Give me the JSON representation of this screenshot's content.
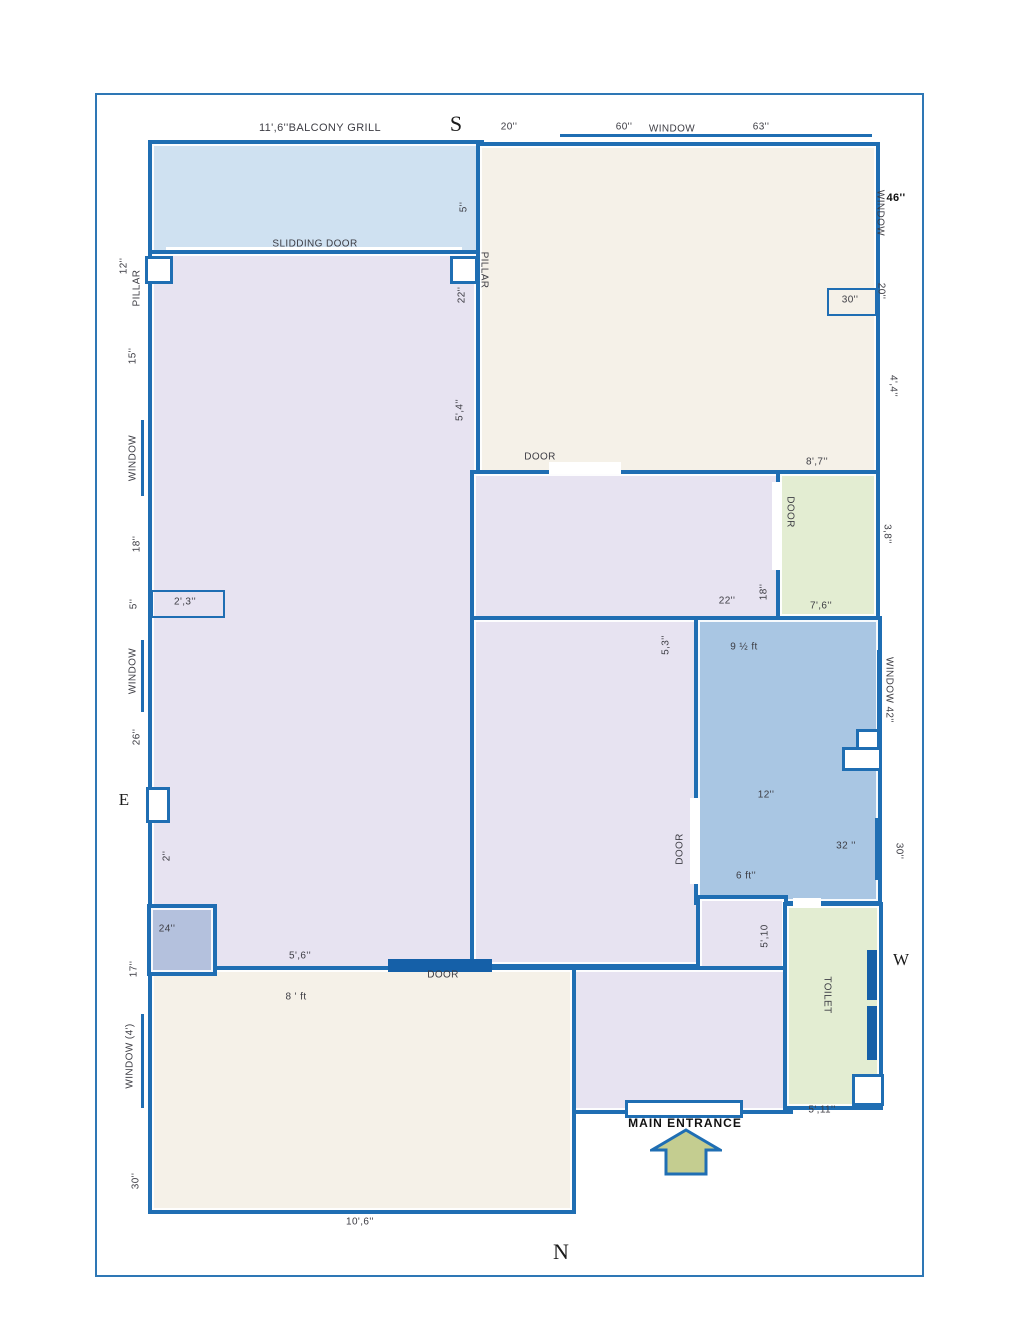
{
  "labels": {
    "balcony_grill": "11',6''BALCONY GRILL",
    "slidding_door": "SLIDDING DOOR",
    "door": "DOOR",
    "window": "WINDOW",
    "window_42": "WINDOW 42''",
    "window_4ft": "WINDOW  (4')",
    "pillar": "PILLAR",
    "toilet": "TOILET",
    "main_entrance": "MAIN ENTRANCE"
  },
  "compass": {
    "s": "S",
    "e": "E",
    "w": "W",
    "n": "N"
  },
  "dims": {
    "top_20": "20''",
    "top_60": "60''",
    "top_63": "63''",
    "right_46": "46''",
    "right_20": "20''",
    "right_30_box": "30''",
    "right_4_4": "4',4''",
    "right_8_7": "8',7''",
    "right_3_8": "3,8''",
    "right_7_6": "7',6''",
    "right_30": "30''",
    "mid_22": "22''",
    "mid_18": "18''",
    "blue_9half": "9 ½ ft",
    "blue_12": "12''",
    "blue_32": "32 ''",
    "blue_6ft": "6 ft''",
    "center_5_3": "5,3''",
    "center_5_10": "5',10",
    "center_5_11": "5',11''",
    "center_5_4": "5',4''",
    "left_12": "12''",
    "left_15": "15''",
    "left_18": "18''",
    "left_5": "5''",
    "left_2_3": "2',3''",
    "left_26": "26''",
    "left_2": "2''",
    "left_24": "24''",
    "left_17": "17''",
    "left_30": "30''",
    "balcony_5": "5''",
    "pillar_22": "22''",
    "bottom_5_6": "5',6''",
    "bottom_8ft": "8 ' ft",
    "bottom_10_6": "10',6''"
  },
  "colors": {
    "wall": "#1f6eb3",
    "wall_dark": "#1560a8",
    "page_border": "#2e77b5",
    "balcony_fill": "#cfe1f1",
    "lavender_fill": "#e7e3f1",
    "cream_fill": "#f5f1e8",
    "green_fill": "#e3edd2",
    "blue_room_fill": "#a9c6e3",
    "small_square_fill": "#b4c1dd",
    "arrow_fill": "#c4cd90",
    "text": "#3d3d44"
  }
}
